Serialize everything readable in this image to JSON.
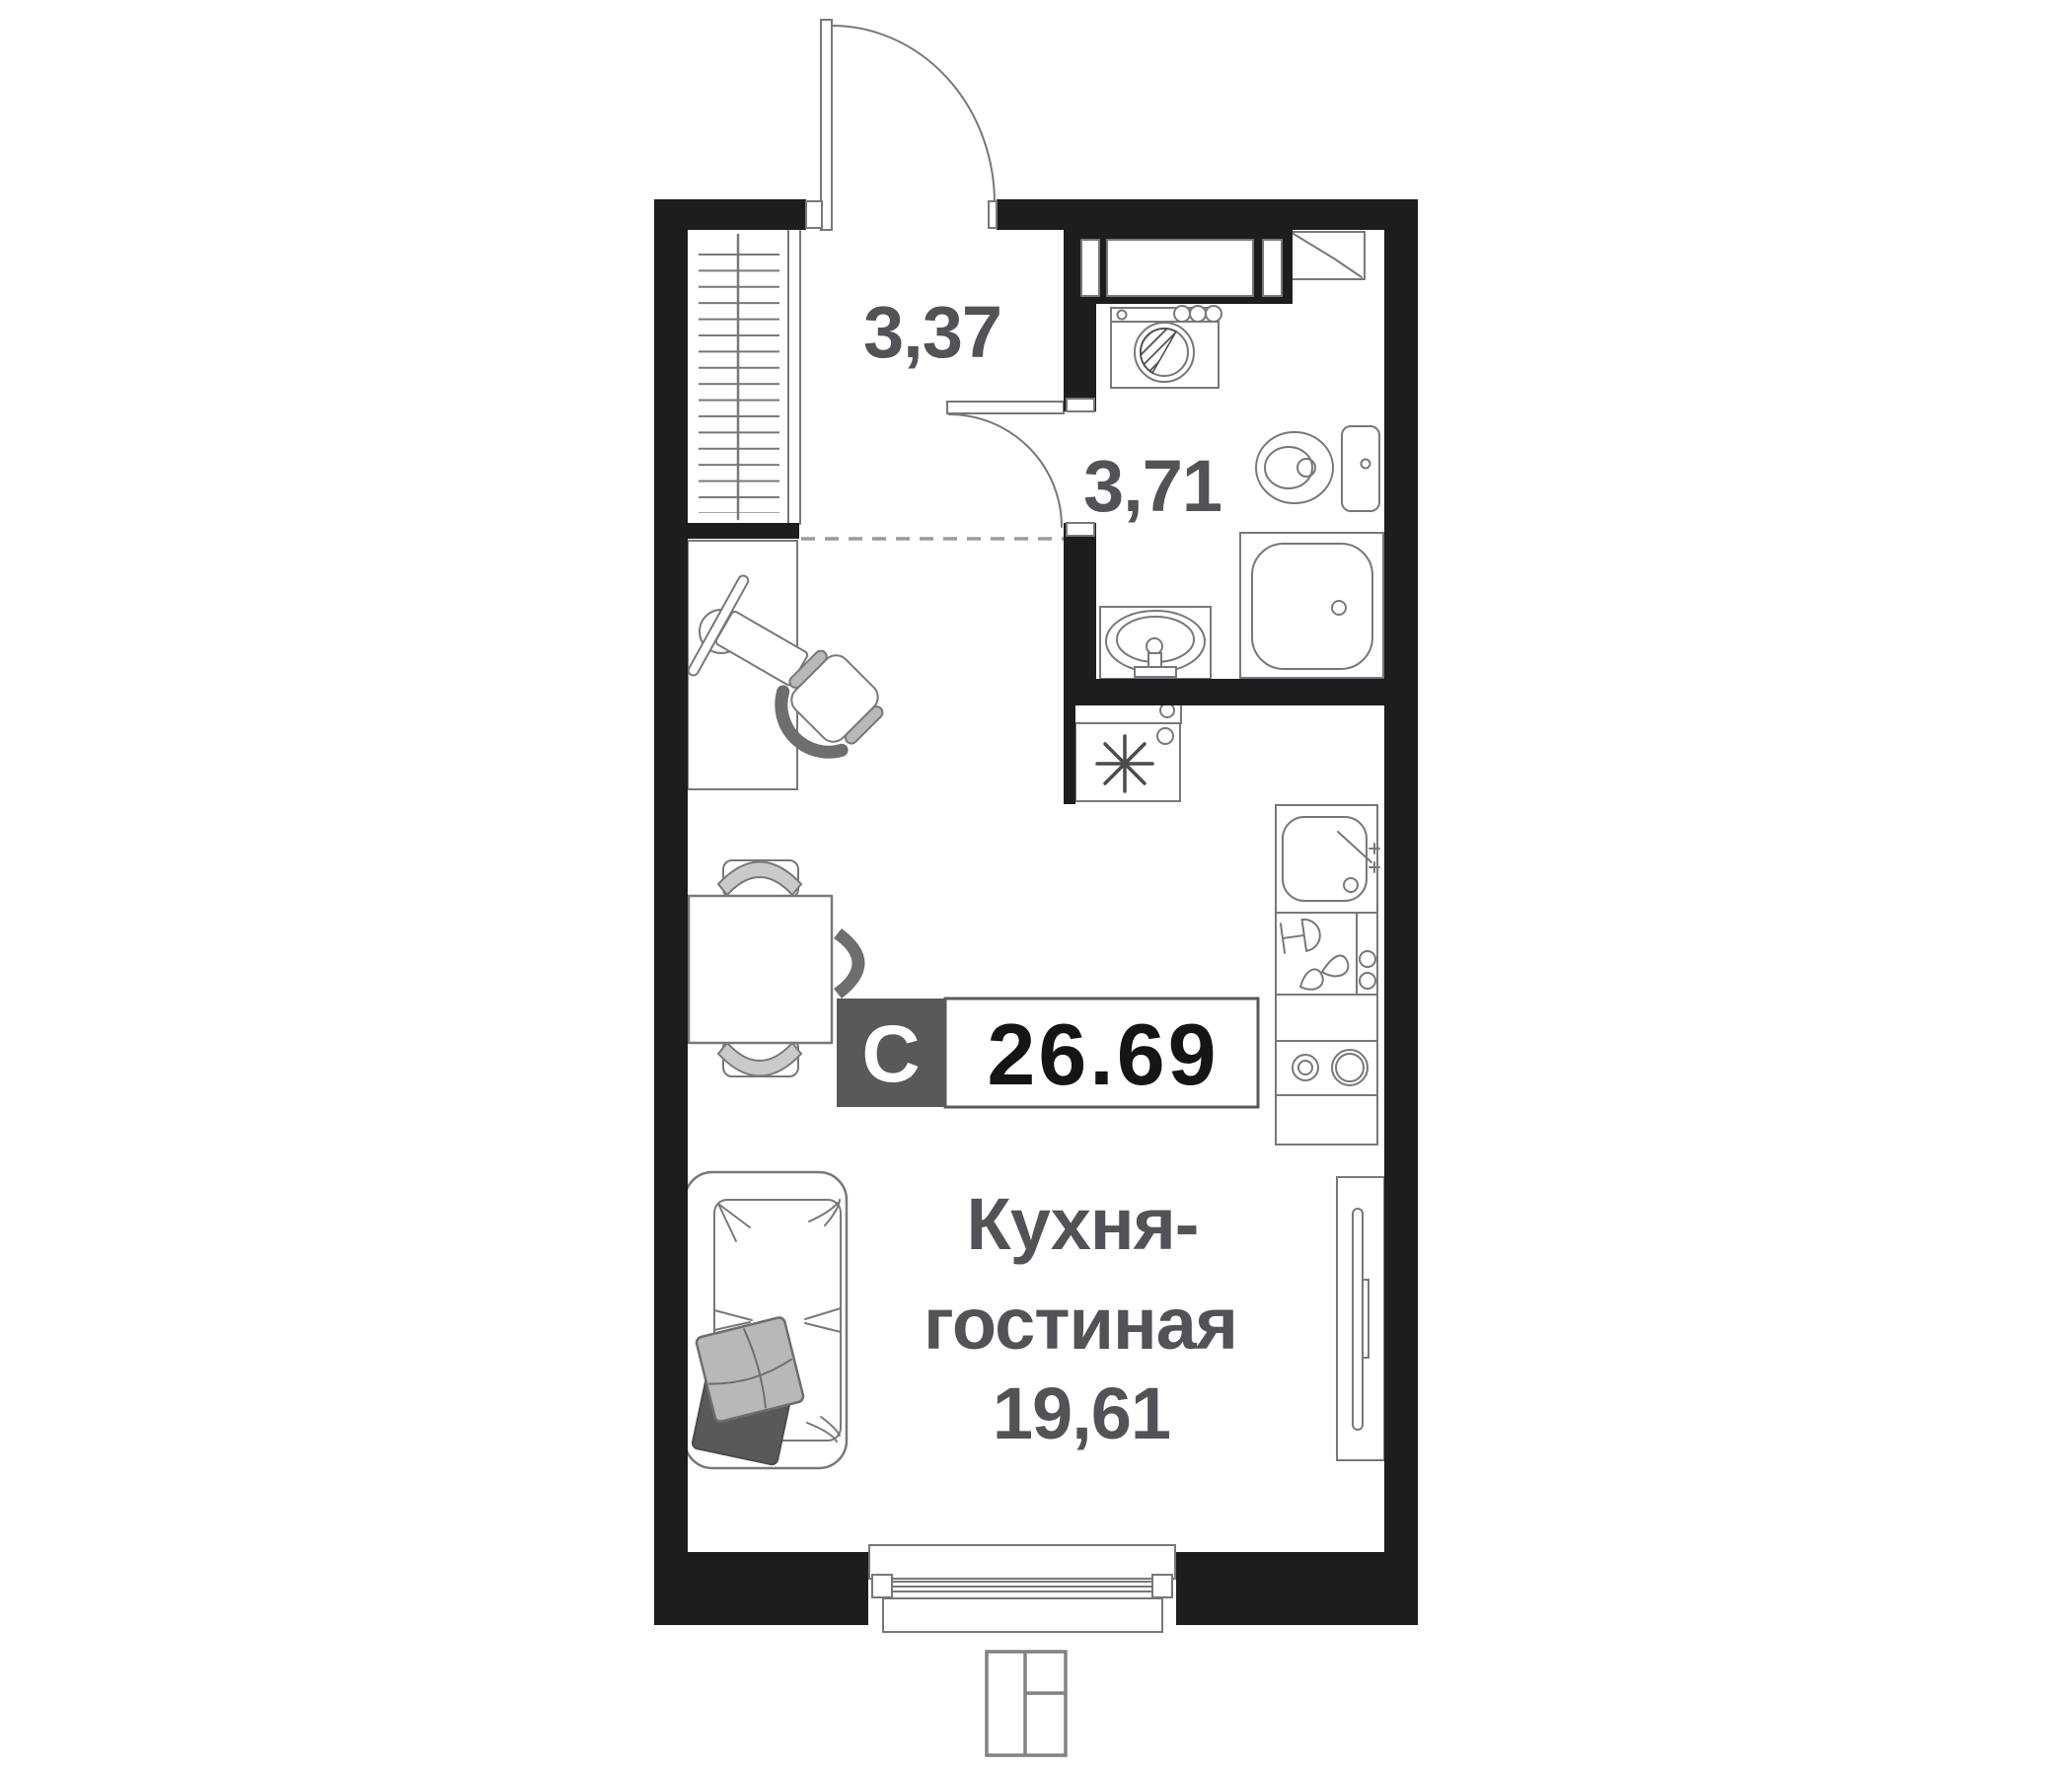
{
  "badge": {
    "type_letter": "С",
    "total_area": "26.69"
  },
  "rooms": {
    "hallway": {
      "area": "3,37"
    },
    "bathroom": {
      "area": "3,71"
    },
    "kitchen_living": {
      "name_line1": "Кухня-",
      "name_line2": "гостиная",
      "area": "19,61"
    }
  },
  "symbols": {
    "wardrobe": "wardrobe-with-hangers",
    "entry_door": "door-arc",
    "bathroom_door": "door-arc",
    "washing_machine": "washer-drum-circle",
    "toilet": "toilet-with-tank",
    "bathroom_sink": "oval-basin",
    "shower": "shower-tray-with-drain",
    "desk": "desk-with-monitor-keyboard",
    "office_chair": "swivel-chair",
    "dining_table": "square-table-three-chairs",
    "sofa": "sofa-with-pillows",
    "fridge": "snowflake-box",
    "kitchen_sink": "square-sink-with-faucet",
    "dish_drainer": "glass-and-drops",
    "stove": "two-burners",
    "tv_console": "tv-panel",
    "window": "double-glazing",
    "vent_duct": "rect-with-diagonal",
    "locator_pictogram": "split-rectangle"
  },
  "colors": {
    "wall": "#1d1d1f",
    "line": "#77787b",
    "dark_line": "#4a4b4d",
    "dash_line": "#9a9b9d",
    "label": "#515356",
    "badge_bg": "#58595b",
    "badge_letter": "#ffffff",
    "badge_num": "#151515",
    "pillow_light": "#b7b8ba",
    "pillow_dark": "#58595b",
    "chair_band": "#c9cacb",
    "chair_dark": "#6d6e70"
  }
}
